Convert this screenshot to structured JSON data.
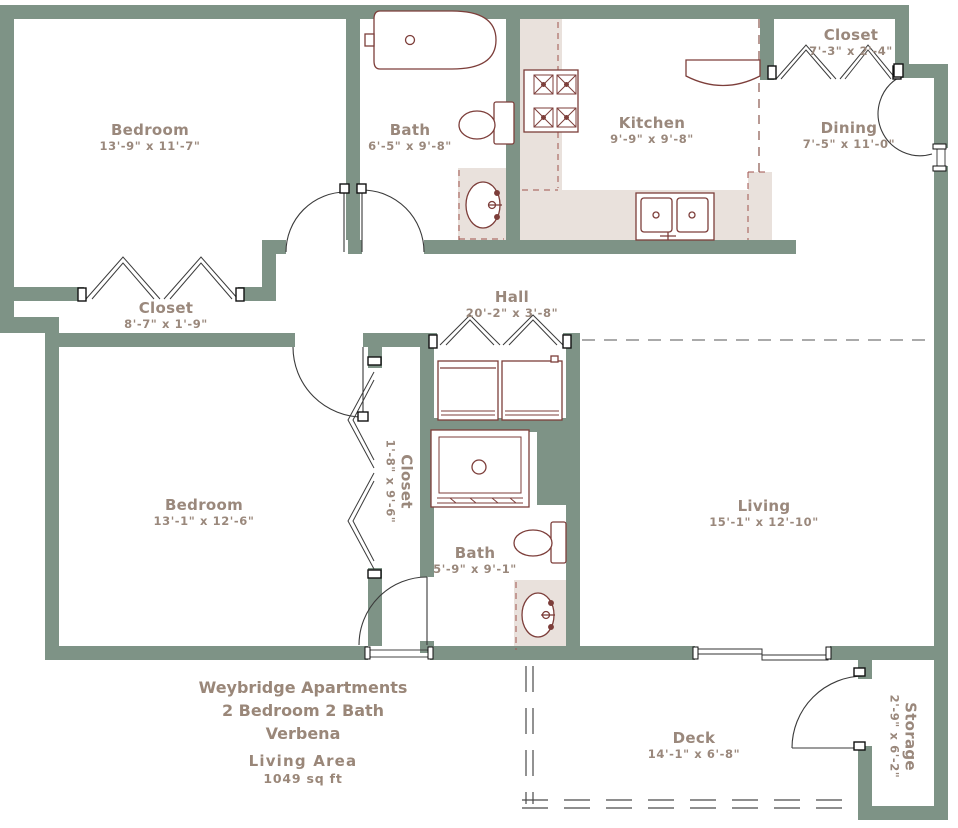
{
  "plan": {
    "colors": {
      "wall": "#7e9386",
      "fixture": "#7d3e3a",
      "counter": "#e9e1dc",
      "label_text": "#9a887c",
      "dash_gray": "#777777",
      "dash_red": "#a0524d"
    },
    "rooms": [
      {
        "id": "bedroom-1",
        "name": "Bedroom",
        "dims": "13'-9\" x 11'-7\""
      },
      {
        "id": "bath-1",
        "name": "Bath",
        "dims": "6'-5\" x 9'-8\""
      },
      {
        "id": "kitchen",
        "name": "Kitchen",
        "dims": "9'-9\" x 9'-8\""
      },
      {
        "id": "closet-1",
        "name": "Closet",
        "dims": "7'-3\" x 2'-4\""
      },
      {
        "id": "dining",
        "name": "Dining",
        "dims": "7'-5\" x 11'-0\""
      },
      {
        "id": "closet-2",
        "name": "Closet",
        "dims": "8'-7\" x 1'-9\""
      },
      {
        "id": "hall",
        "name": "Hall",
        "dims": "20'-2\" x 3'-8\""
      },
      {
        "id": "bedroom-2",
        "name": "Bedroom",
        "dims": "13'-1\" x 12'-6\""
      },
      {
        "id": "closet-3",
        "name": "Closet",
        "dims": "1'-8\" x 9'-6\""
      },
      {
        "id": "bath-2",
        "name": "Bath",
        "dims": "5'-9\" x 9'-1\""
      },
      {
        "id": "living",
        "name": "Living",
        "dims": "15'-1\" x 12'-10\""
      },
      {
        "id": "deck",
        "name": "Deck",
        "dims": "14'-1\" x 6'-8\""
      },
      {
        "id": "storage",
        "name": "Storage",
        "dims": "2'-9\" x 6'-2\""
      }
    ],
    "title_block": {
      "line1": "Weybridge Apartments",
      "line2": "2 Bedroom 2 Bath",
      "line3": "Verbena",
      "line4": "Living Area",
      "line5": "1049 sq ft"
    }
  }
}
